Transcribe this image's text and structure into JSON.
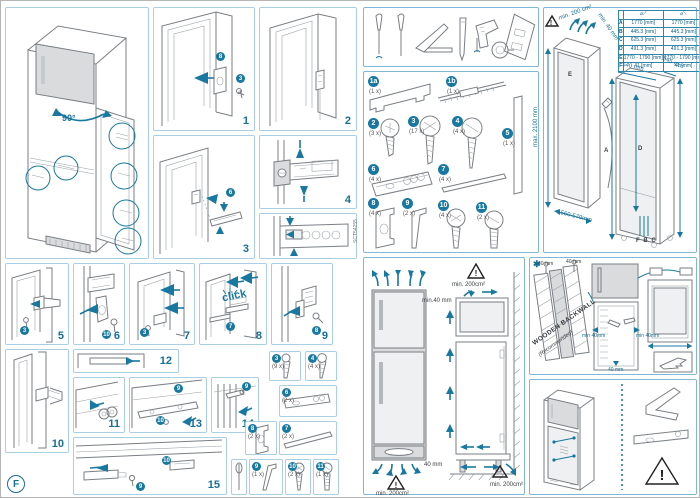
{
  "doc": {
    "page_letter": "F",
    "side_code": "SCT54255"
  },
  "colors": {
    "accent": "#1878a0",
    "line": "#7a7f84",
    "panel_border": "#a8cfe3",
    "gray_fill": "#d9dbdd"
  },
  "overview": {
    "angle_label": "90°"
  },
  "click_label": "click",
  "step_labels": {
    "n1": "1",
    "n2": "2",
    "n3": "3",
    "n4": "4",
    "n5": "5",
    "n6": "6",
    "n7": "7",
    "n8": "8",
    "n9": "9",
    "n10": "10",
    "n11": "11",
    "n12": "12",
    "n13": "13",
    "n14": "14",
    "n15": "15"
  },
  "badges": {
    "b1a": "8",
    "b1b": "3",
    "b3": "6",
    "b4": "6",
    "b5": "3",
    "b6": "10",
    "b8": "7",
    "b9": "8",
    "b11": "3",
    "b12": "7",
    "b13a": "9",
    "b13b": "10",
    "b14": "9",
    "b15a": "10",
    "b15b": "9"
  },
  "parts": {
    "items": [
      {
        "id": "1a",
        "qty": "(1 x)"
      },
      {
        "id": "1b",
        "qty": "(1 x)"
      },
      {
        "id": "2",
        "qty": "(3 x)"
      },
      {
        "id": "3",
        "qty": "(17 x)"
      },
      {
        "id": "4",
        "qty": "(4 x)"
      },
      {
        "id": "5",
        "qty": "(1 x)"
      },
      {
        "id": "6",
        "qty": "(4 x)"
      },
      {
        "id": "7",
        "qty": "(4 x)"
      },
      {
        "id": "8",
        "qty": "(4 x)"
      },
      {
        "id": "9",
        "qty": "(2 x)"
      },
      {
        "id": "10",
        "qty": "(4 x)"
      },
      {
        "id": "11",
        "qty": "(2 x)"
      }
    ]
  },
  "inline_parts": [
    {
      "ref": "3",
      "qty": "(9 x)"
    },
    {
      "ref": "4",
      "qty": "(4 x)"
    },
    {
      "ref": "6",
      "qty": "(2 x)"
    },
    {
      "ref": "8",
      "qty": "(2 x)"
    },
    {
      "ref": "7",
      "qty": "(2 x)"
    },
    {
      "ref": "9",
      "qty": "(1 x)"
    },
    {
      "ref": "10",
      "qty": "(2 x)"
    },
    {
      "ref": "11",
      "qty": "(1 x)"
    }
  ],
  "dimensions_panel": {
    "vent_label": "min. 200 cm²",
    "gap_label": "min. 40 mm",
    "max_height": "max. 2100 mm",
    "niche_depth": "560-570mm",
    "unit_width": "540 mm",
    "unit_depth": "545 mm",
    "dim_a": "A",
    "dim_d": "D",
    "dim_e": "E",
    "dim_fbc": "F B C",
    "table": {
      "rows": [
        [
          "A",
          "1770 [mm]",
          "1770 [mm]"
        ],
        [
          "B",
          "445.3 [mm]",
          "445.3 [mm]"
        ],
        [
          "C",
          "625.3 [mm]",
          "625.3 [mm]"
        ],
        [
          "D",
          "491.3 [mm]",
          "491.3 [mm]"
        ],
        [
          "E",
          "1770 - 1790 [mm]",
          "1770 - 1790 [mm]"
        ],
        [
          "F",
          "41 [mm]",
          "41 [mm]"
        ]
      ]
    }
  },
  "ventilation_panel": {
    "warn_top": "min. 200cm²",
    "warn_bottom": "min. 200cm²",
    "warn_right": "min. 200cm²",
    "top_gap": "min.40 mm",
    "bottom_gap": "40 mm"
  },
  "backwall_panel": {
    "star": "✱",
    "title": "WOODEN BACKWALL",
    "subtitle": "(Recommended)",
    "tag_left": "40 mm",
    "tag_right": "40 mm",
    "gap_left": "min 40mm",
    "gap_right": "min 40mm",
    "gap_bottom": "40 mm"
  }
}
